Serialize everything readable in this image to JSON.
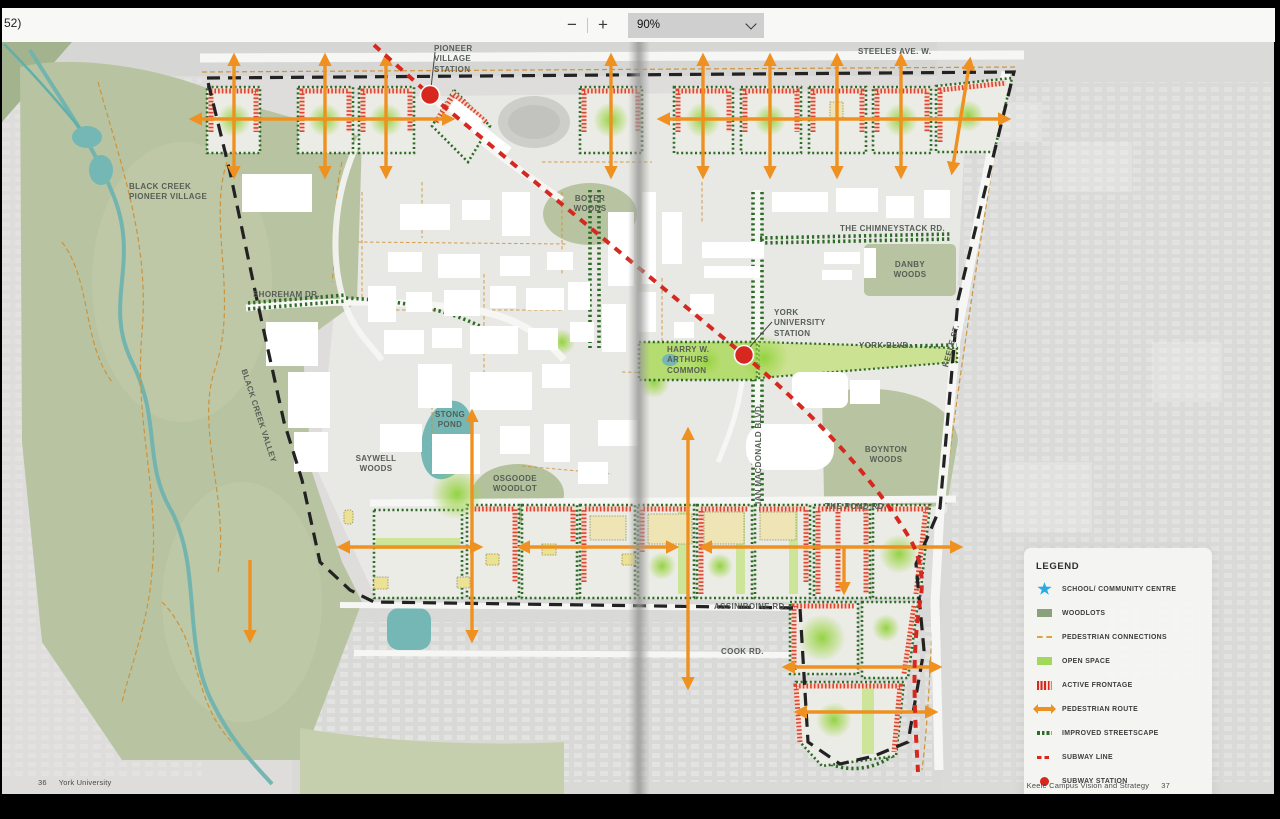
{
  "window": {
    "partial_page_indicator": "52)"
  },
  "toolbar": {
    "zoom_out_label": "−",
    "zoom_in_label": "+",
    "zoom_level": "90%"
  },
  "map": {
    "labels": {
      "pioneer_village_station": "PIONEER\nVILLAGE\nSTATION",
      "steeles_ave": "STEELES AVE. W.",
      "black_creek_pioneer_village": "BLACK CREEK\nPIONEER VILLAGE",
      "boyer_woods": "BOYER\nWOODS",
      "chimneystack_rd": "THE CHIMNEYSTACK RD.",
      "danby_woods": "DANBY\nWOODS",
      "shoreham_dr": "SHOREHAM DR.",
      "york_university_station": "YORK\nUNIVERSITY\nSTATION",
      "york_blvd": "YORK BLVD.",
      "keele_st": "KEELE ST.",
      "harry_arthurs_common": "HARRY W.\nARTHURS\nCOMMON",
      "stong_pond": "STONG\nPOND",
      "saywell_woods": "SAYWELL\nWOODS",
      "osgoode_woodlot": "OSGOODE\nWOODLOT",
      "black_creek_valley": "BLACK CREEK VALLEY",
      "ian_macdonald_blvd": "IAN MACDONALD BLVD.",
      "boynton_woods": "BOYNTON\nWOODS",
      "the_pond_rd": "THE POND RD.",
      "assiniboine_rd": "ASSINIBOINE RD.",
      "cook_rd": "COOK RD."
    }
  },
  "legend": {
    "title": "LEGEND",
    "items": [
      {
        "icon": "star",
        "label": "SCHOOL/ COMMUNITY CENTRE"
      },
      {
        "icon": "woodlots",
        "label": "WOODLOTS"
      },
      {
        "icon": "pedestrian-connections",
        "label": "PEDESTRIAN CONNECTIONS"
      },
      {
        "icon": "open-space",
        "label": "OPEN SPACE"
      },
      {
        "icon": "active-frontage",
        "label": "ACTIVE FRONTAGE"
      },
      {
        "icon": "pedestrian-route",
        "label": "PEDESTRIAN ROUTE"
      },
      {
        "icon": "improved-streetscape",
        "label": "IMPROVED STREETSCAPE"
      },
      {
        "icon": "subway-line",
        "label": "SUBWAY LINE"
      },
      {
        "icon": "subway-station",
        "label": "SUBWAY STATION"
      }
    ]
  },
  "footer": {
    "left_page_number": "36",
    "left_text": "York University",
    "right_text": "Keele Campus Vision and Strategy",
    "right_page_number": "37"
  },
  "colors": {
    "accent_orange": "#EF9121",
    "woodlot_green": "#8BA17B",
    "open_space_green": "#A2D95D",
    "streetscape_green": "#2D6B26",
    "subway_red": "#D7281F",
    "star_blue": "#29ABE2"
  }
}
